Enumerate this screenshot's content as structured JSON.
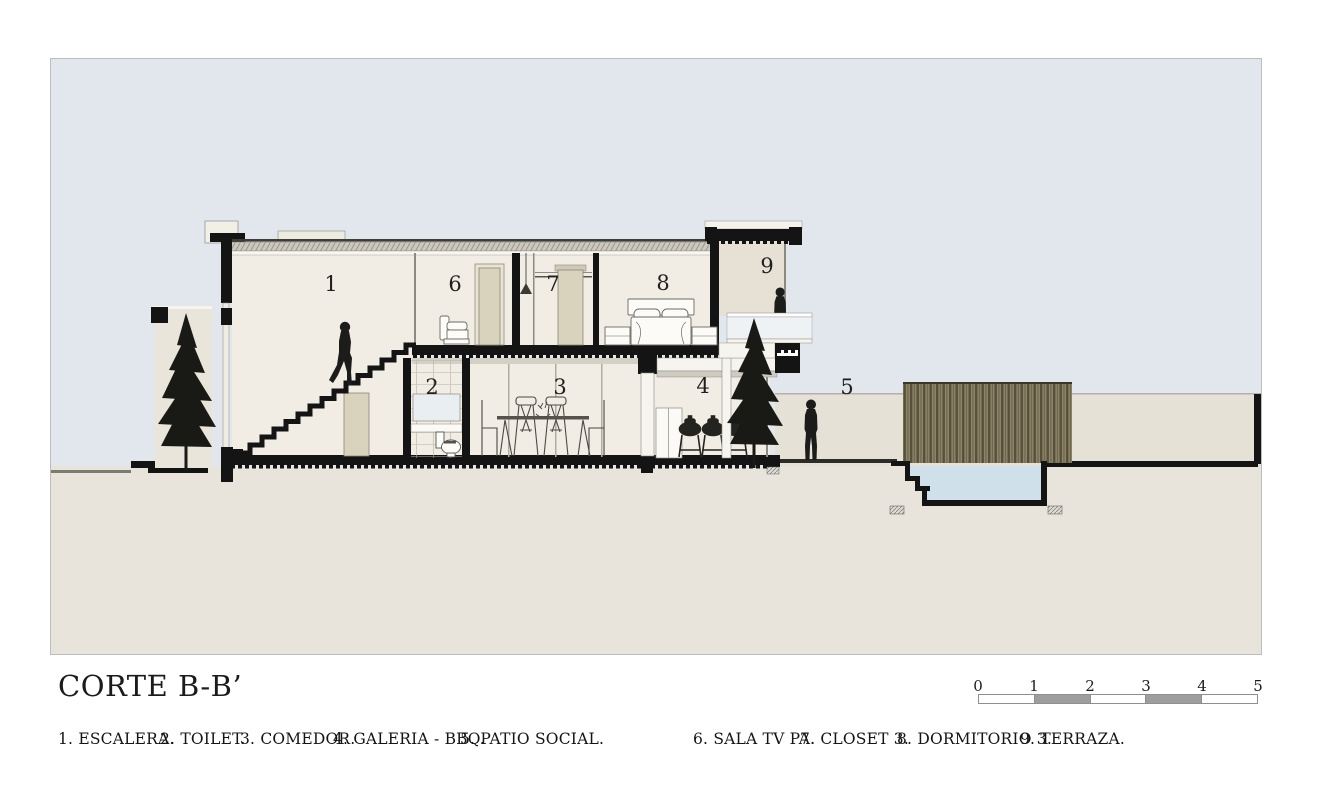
{
  "title": "CORTE B-B’",
  "rooms": [
    {
      "number": "1",
      "name": "ESCALERA"
    },
    {
      "number": "2",
      "name": "TOILET"
    },
    {
      "number": "3",
      "name": "COMEDOR"
    },
    {
      "number": "4",
      "name": "GALERIA - BBQ"
    },
    {
      "number": "5",
      "name": "PATIO SOCIAL"
    },
    {
      "number": "6",
      "name": "SALA TV PA"
    },
    {
      "number": "7",
      "name": "CLOSET 3"
    },
    {
      "number": "8",
      "name": "DORMITORIO 3"
    },
    {
      "number": "9",
      "name": "TERRAZA"
    }
  ],
  "legend": {
    "items": [
      "1. ESCALERA.",
      "2. TOILET.",
      "3. COMEDOR.",
      "4. GALERIA - BBQ.",
      "5. PATIO SOCIAL.",
      "6. SALA TV PA.",
      "7. CLOSET 3.",
      "8. DORMITORIO 3.",
      "9. TERRAZA."
    ]
  },
  "scalebar": {
    "labels": [
      "0",
      "1",
      "2",
      "3",
      "4",
      "5"
    ]
  },
  "colors": {
    "sky": "#e1e7ec",
    "ground": "#e9e4db",
    "patio_wall": "#e6e1d6",
    "interior": "#f1ede4",
    "terrace_wall": "#e6e0d5",
    "garden_wall": "#eae5da",
    "line_black": "#141414",
    "roof_gray": "#ccc8be",
    "water": "#cfe0ea",
    "fence_wood": "#8f8468",
    "glass": "#eef2f5",
    "door": "#d9d2bd"
  }
}
